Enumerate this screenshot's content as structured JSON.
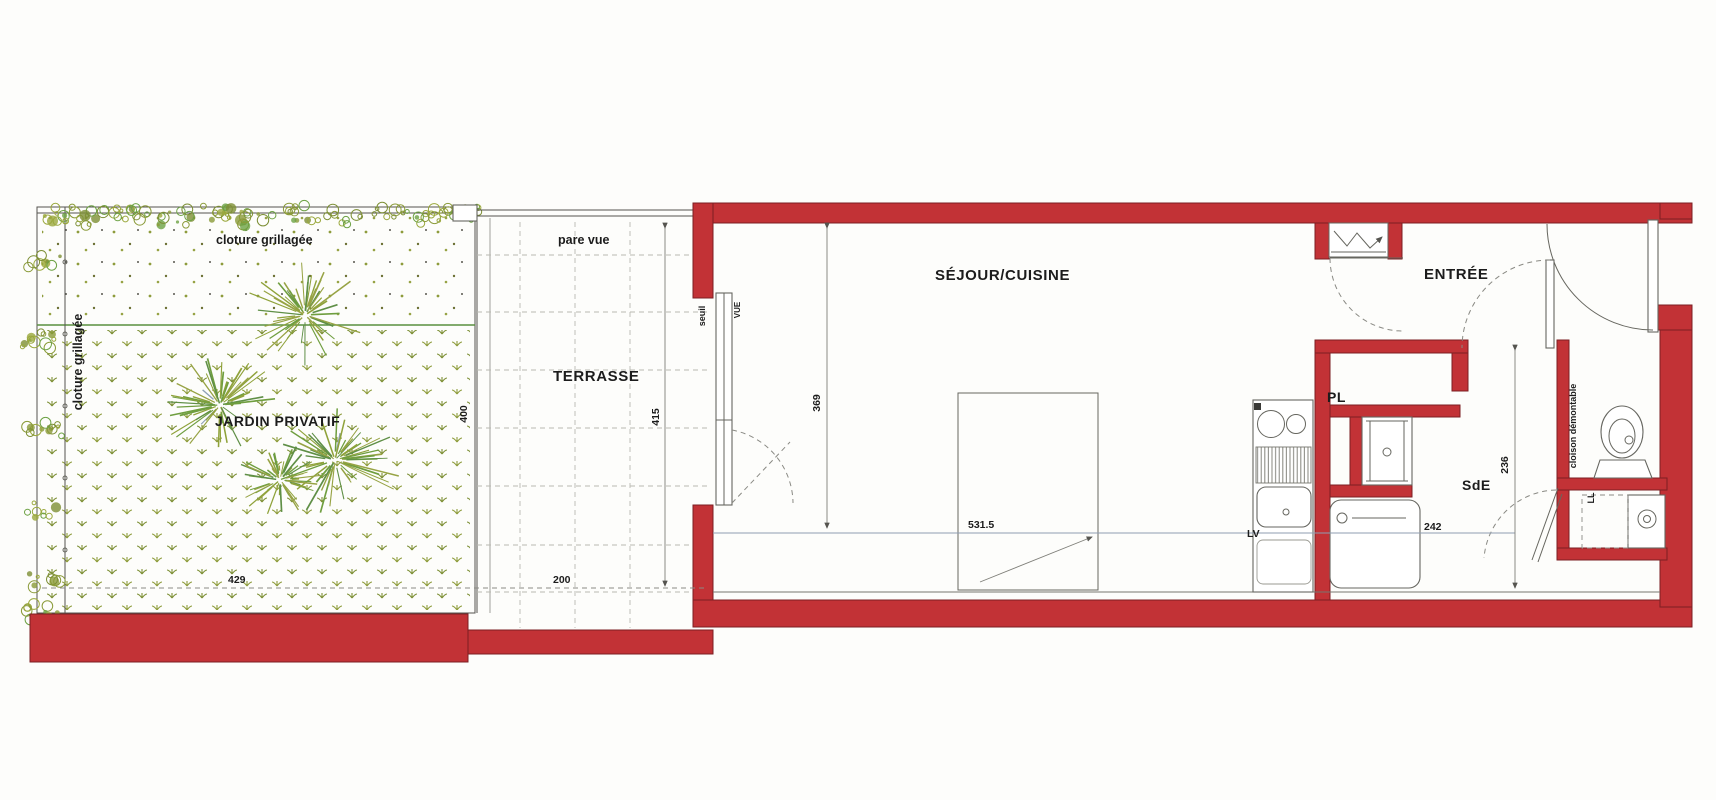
{
  "plan": {
    "rooms": {
      "garden": {
        "label": "JARDIN PRIVATIF"
      },
      "terrace": {
        "label": "TERRASSE"
      },
      "living": {
        "label": "SÉJOUR/CUISINE"
      },
      "entry": {
        "label": "ENTRÉE"
      },
      "shower_room": {
        "label": "SdE"
      },
      "closet": {
        "label": "PL"
      }
    },
    "annotations": {
      "fence_top": "cloture grillagée",
      "fence_left": "cloture grillagée",
      "screen": "pare vue",
      "threshold": "seuil",
      "view": "VUE",
      "dishwasher": "LV",
      "washer": "LL",
      "removable_partition": "cloison démontable"
    },
    "dimensions": {
      "garden_width": "429",
      "garden_depth": "400",
      "terrace_width": "200",
      "terrace_depth": "415",
      "living_depth": "369",
      "living_width": "531.5",
      "shower_room_width": "242",
      "shower_room_depth": "236"
    },
    "colors": {
      "wall_red": "#c23236",
      "wall_outline": "#7c1f23",
      "vegetation_olive": "#8e9c3c",
      "tree_green": "#6f9e3f",
      "grass_line_green": "#5a9040",
      "plan_line": "#55544f",
      "dimension_line_blue": "#8f9db1",
      "text": "#1c1c1c"
    }
  }
}
